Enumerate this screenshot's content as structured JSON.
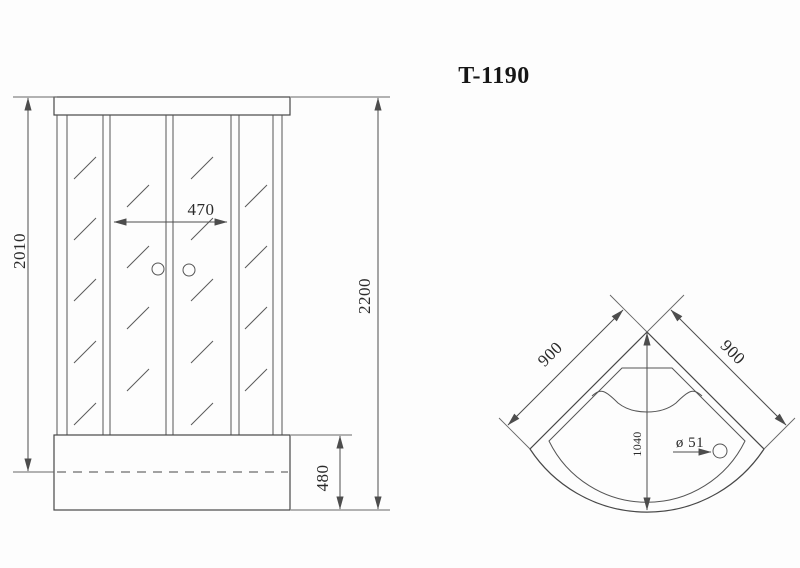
{
  "title": "T-1190",
  "front_view": {
    "dim_glass_height": "2010",
    "dim_door_width": "470",
    "dim_total_height": "2200",
    "dim_tray_height": "480"
  },
  "plan_view": {
    "dim_side_left": "900",
    "dim_side_right": "900",
    "dim_depth": "1040",
    "dim_drain": "ø 51"
  }
}
